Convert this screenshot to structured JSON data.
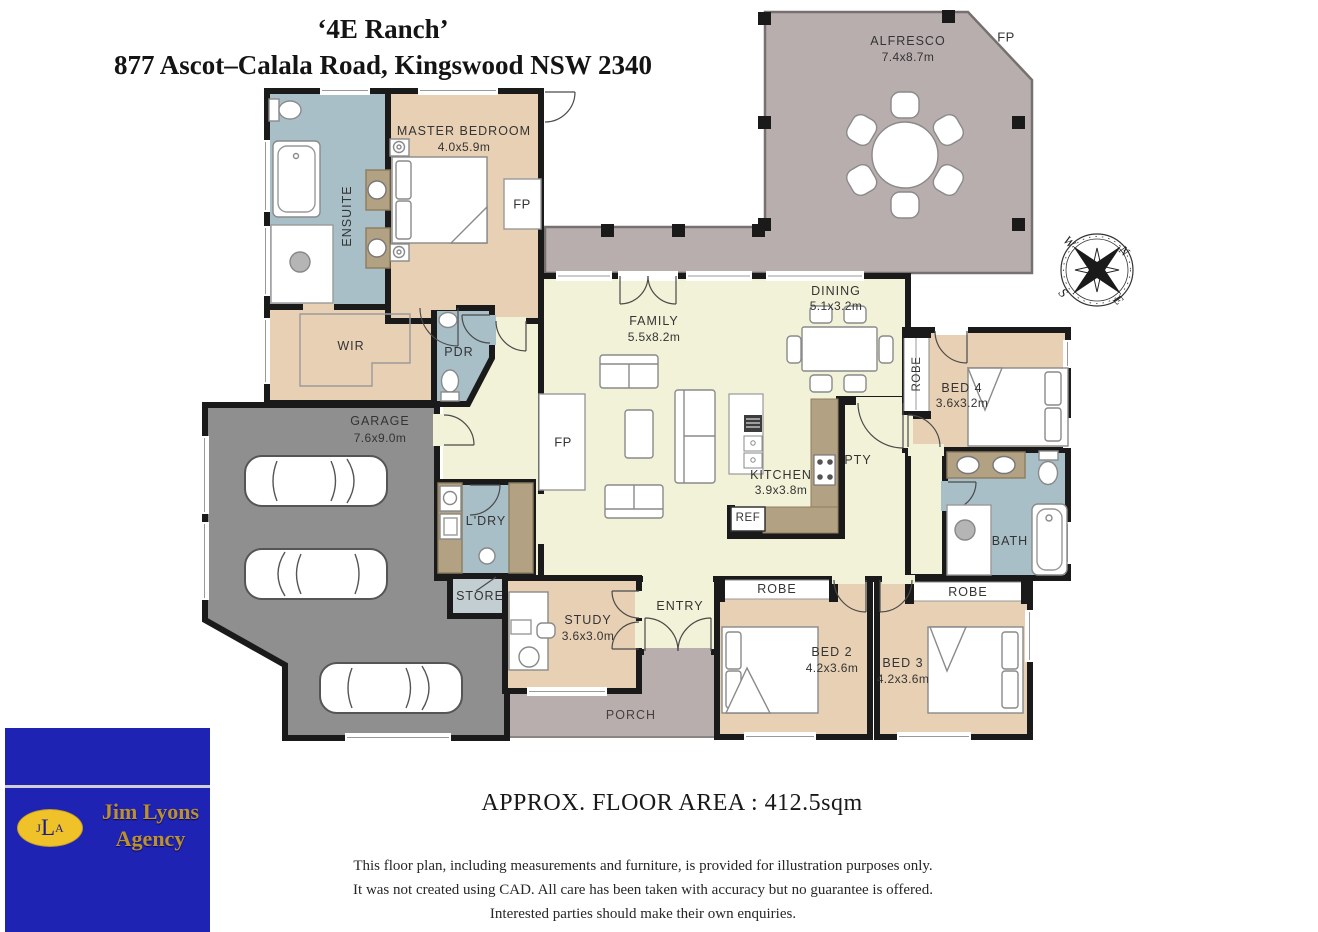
{
  "title": {
    "line1": "‘4E Ranch’",
    "line2": "877 Ascot–Calala Road, Kingswood NSW 2340"
  },
  "rooms": {
    "master": {
      "name": "MASTER BEDROOM",
      "dims": "4.0x5.9m"
    },
    "ensuite": {
      "name": "ENSUITE"
    },
    "wir": {
      "name": "WIR"
    },
    "pdr": {
      "name": "PDR"
    },
    "garage": {
      "name": "GARAGE",
      "dims": "7.6x9.0m"
    },
    "ldry": {
      "name": "L'DRY"
    },
    "store": {
      "name": "STORE"
    },
    "study": {
      "name": "STUDY",
      "dims": "3.6x3.0m"
    },
    "entry": {
      "name": "ENTRY"
    },
    "porch": {
      "name": "PORCH"
    },
    "family": {
      "name": "FAMILY",
      "dims": "5.5x8.2m"
    },
    "dining": {
      "name": "DINING",
      "dims": "5.1x3.2m"
    },
    "kitchen": {
      "name": "KITCHEN",
      "dims": "3.9x3.8m"
    },
    "pty": {
      "name": "PTY"
    },
    "ref": {
      "name": "REF"
    },
    "alfresco": {
      "name": "ALFRESCO",
      "dims": "7.4x8.7m"
    },
    "bed4": {
      "name": "BED 4",
      "dims": "3.6x3.2m"
    },
    "bath": {
      "name": "BATH"
    },
    "bed2": {
      "name": "BED 2",
      "dims": "4.2x3.6m"
    },
    "bed3": {
      "name": "BED 3",
      "dims": "4.2x3.6m"
    }
  },
  "tags": {
    "fp": "FP",
    "robe": "ROBE"
  },
  "compass": {
    "n": "N",
    "e": "E",
    "s": "S",
    "w": "W"
  },
  "logo": {
    "mono_j": "J",
    "mono_l": "L",
    "mono_a": "A",
    "name_line1": "Jim Lyons",
    "name_line2": "Agency"
  },
  "footer": {
    "floor_area": "APPROX. FLOOR AREA : 412.5sqm",
    "disclaimer_line1": "This floor plan, including measurements and furniture, is provided for illustration purposes only.",
    "disclaimer_line2": "It was not created using CAD. All care has been taken with accuracy but no guarantee is offered.",
    "disclaimer_line3": "Interested parties should make their own enquiries."
  },
  "colors": {
    "bedroom_tan": "#e8d0b4",
    "wet_area_blue": "#a8bfc8",
    "living_cream": "#f2f2d8",
    "outdoor_mauve": "#b9aeae",
    "garage_grey": "#8f8f8f",
    "bench_granite": "#b2a183",
    "wall_black": "#1a1a1a",
    "logo_blue": "#1e23b4",
    "logo_gold": "#f0c22a"
  }
}
